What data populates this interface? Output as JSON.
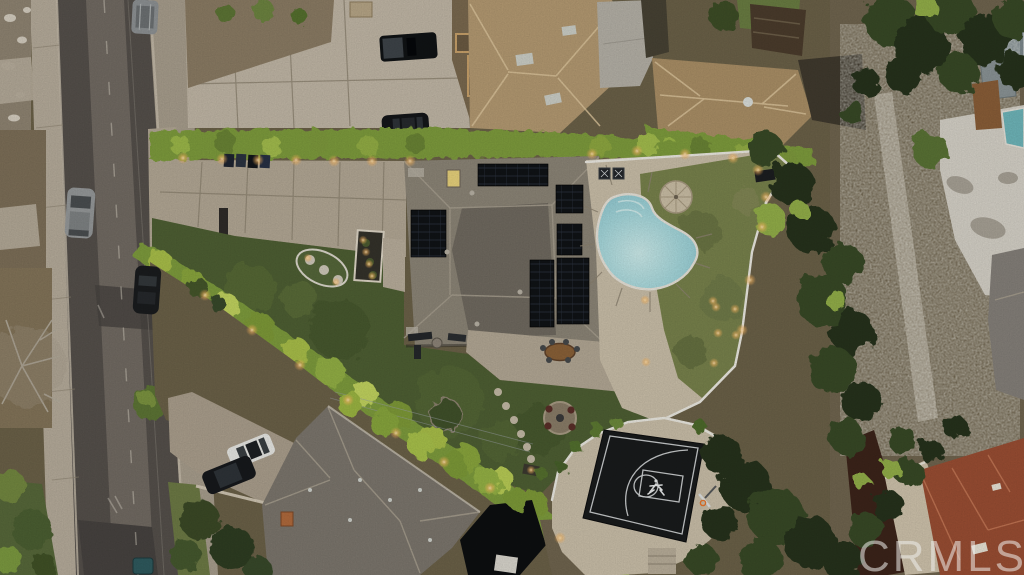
{
  "watermark": "CRMLS",
  "scene": {
    "type": "aerial-drone-photo",
    "subject": "residential estate with pool, pergola, lit hedges and backyard basketball court",
    "features": [
      "street",
      "driveway",
      "main-house-solar-roof",
      "swimming-pool",
      "umbrella",
      "pergola-dining",
      "front-lawn",
      "illuminated-hedge",
      "basketball-half-court",
      "second-house-roof",
      "neighbor-houses",
      "trees",
      "parked-cars"
    ]
  },
  "palette": {
    "asphalt": "#55504b",
    "asphaltDark": "#474340",
    "roadCenter": "#8a8279",
    "sidewalk": "#b6ac9b",
    "concrete": "#b3a895",
    "ndrive": "#c1b7a6",
    "deck": "#cabfa9",
    "lawn": "#4e5f33",
    "drygrass": "#78824c",
    "parkgrass": "#6d7a45",
    "hedge": "#7e9c3e",
    "hedgeBright": "#aec24f",
    "treeDark": "#26331c",
    "tree": "#384a27",
    "treeLime": "#93af48",
    "roof": "#8c8577",
    "roofDark": "#6d675d",
    "roof2": "#7c766d",
    "tanroof": "#b49a72",
    "tanroof2": "#aa8f66",
    "redroof": "#9a4e33",
    "solar": "#101316",
    "fence": "#eceae2",
    "dirt": "#70654f",
    "scrub": "#6b6148",
    "court": "#191b1c",
    "courtLine": "#d7dadb",
    "joint": "#8e8472",
    "white": "#e9e9e6",
    "cream": "#cfc3ac",
    "walldark": "#3c241a",
    "lightWarm": "#ffc06a",
    "npool": "#6fb6ba",
    "poolWater": "#9ed2d8"
  }
}
